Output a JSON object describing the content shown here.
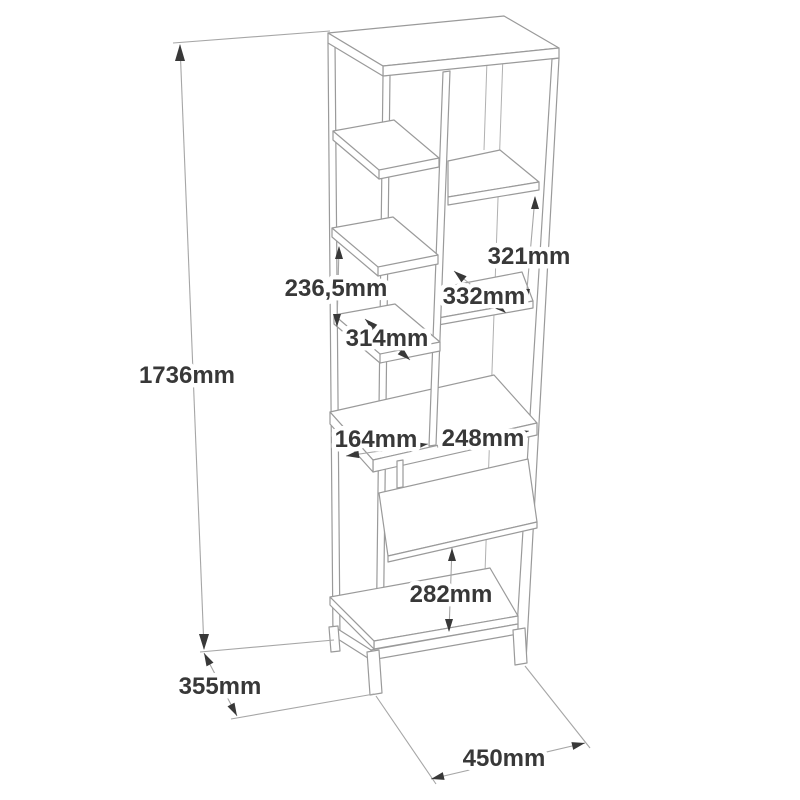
{
  "drawing": {
    "type": "furniture-dimension-diagram",
    "subject": "tall-open-shelf-bookcase",
    "unit": "mm",
    "background_color": "#ffffff",
    "line_color": "#9a9a9a",
    "dimension_line_color": "#a6a6a6",
    "arrow_color": "#383838",
    "text_color": "#383838",
    "labels": {
      "total_height": "1736mm",
      "left_shelf_gap": "236,5mm",
      "right_upper_height": "321mm",
      "right_shelf_depth": "332mm",
      "left_shelf_depth": "314mm",
      "left_opening_width": "164mm",
      "right_opening_width": "248mm",
      "lower_opening_height": "282mm",
      "total_depth": "355mm",
      "total_width": "450mm"
    }
  }
}
